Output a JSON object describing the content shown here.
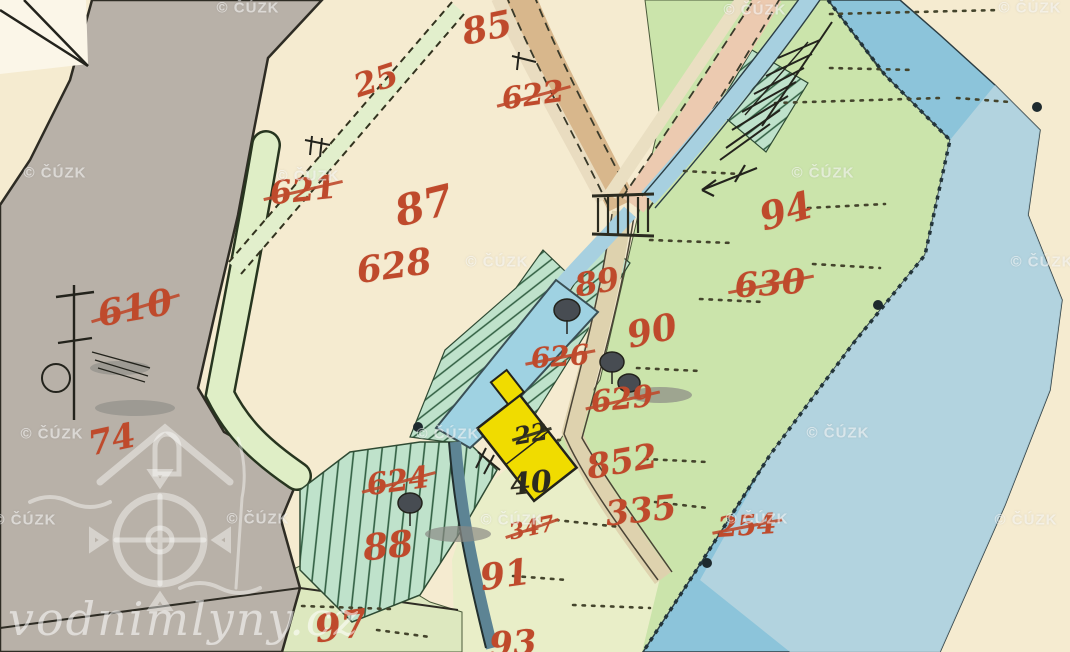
{
  "map": {
    "title": "historical cadastral map scan",
    "palette": {
      "paper": "#f5ebd0",
      "meadow_green": "#cbe4ab",
      "hatch_green": "#bfe2cb",
      "pale_green": "#e9eec8",
      "water_blue": "#8cc4da",
      "pond_blue": "#9fd2e2",
      "road_tan": "#d8b78c",
      "road_pink": "#eccab0",
      "gray_area": "#b8b1a8",
      "building_yellow": "#f0dc00",
      "red_ink": "#bf4a2c",
      "black_ink": "#2b2b20"
    }
  },
  "watermark": {
    "text": "© ČÚZK",
    "positions": [
      [
        248,
        8
      ],
      [
        755,
        10
      ],
      [
        1030,
        8
      ],
      [
        55,
        173
      ],
      [
        308,
        176
      ],
      [
        823,
        173
      ],
      [
        497,
        262
      ],
      [
        1042,
        262
      ],
      [
        52,
        434
      ],
      [
        448,
        434
      ],
      [
        838,
        433
      ],
      [
        25,
        520
      ],
      [
        258,
        519
      ],
      [
        512,
        520
      ],
      [
        757,
        519
      ],
      [
        1026,
        520
      ]
    ]
  },
  "logo_watermark": {
    "text": "vodnimlyny.cz"
  },
  "labels": [
    {
      "text": "85",
      "x": 487,
      "y": 28,
      "rot": -12,
      "size": 36,
      "color": "red",
      "crossed": false
    },
    {
      "text": "622",
      "x": 533,
      "y": 96,
      "rot": -8,
      "size": 30,
      "color": "red",
      "crossed": true
    },
    {
      "text": "25",
      "x": 376,
      "y": 80,
      "rot": -18,
      "size": 32,
      "color": "red",
      "crossed": false
    },
    {
      "text": "621",
      "x": 303,
      "y": 190,
      "rot": -6,
      "size": 32,
      "color": "red",
      "crossed": true
    },
    {
      "text": "87",
      "x": 424,
      "y": 206,
      "rot": -14,
      "size": 42,
      "color": "red",
      "crossed": false
    },
    {
      "text": "628",
      "x": 394,
      "y": 266,
      "rot": -8,
      "size": 36,
      "color": "red",
      "crossed": false
    },
    {
      "text": "610",
      "x": 135,
      "y": 308,
      "rot": -10,
      "size": 36,
      "color": "red",
      "crossed": true
    },
    {
      "text": "74",
      "x": 112,
      "y": 440,
      "rot": -12,
      "size": 34,
      "color": "red",
      "crossed": false
    },
    {
      "text": "94",
      "x": 786,
      "y": 211,
      "rot": -16,
      "size": 38,
      "color": "red",
      "crossed": false
    },
    {
      "text": "630",
      "x": 770,
      "y": 284,
      "rot": -4,
      "size": 34,
      "color": "red",
      "crossed": true
    },
    {
      "text": "89",
      "x": 597,
      "y": 282,
      "rot": -10,
      "size": 32,
      "color": "red",
      "crossed": false
    },
    {
      "text": "626",
      "x": 560,
      "y": 357,
      "rot": -4,
      "size": 28,
      "color": "red",
      "crossed": true
    },
    {
      "text": "90",
      "x": 652,
      "y": 331,
      "rot": -12,
      "size": 36,
      "color": "red",
      "crossed": false
    },
    {
      "text": "629",
      "x": 622,
      "y": 400,
      "rot": -6,
      "size": 30,
      "color": "red",
      "crossed": true
    },
    {
      "text": "852",
      "x": 622,
      "y": 462,
      "rot": -10,
      "size": 34,
      "color": "red",
      "crossed": false
    },
    {
      "text": "335",
      "x": 641,
      "y": 511,
      "rot": -6,
      "size": 34,
      "color": "red",
      "crossed": false
    },
    {
      "text": "254",
      "x": 747,
      "y": 526,
      "rot": -4,
      "size": 28,
      "color": "red",
      "crossed": true
    },
    {
      "text": "624",
      "x": 398,
      "y": 482,
      "rot": -8,
      "size": 30,
      "color": "red",
      "crossed": true
    },
    {
      "text": "88",
      "x": 388,
      "y": 546,
      "rot": -6,
      "size": 36,
      "color": "red",
      "crossed": false
    },
    {
      "text": "347",
      "x": 532,
      "y": 528,
      "rot": -12,
      "size": 22,
      "color": "red",
      "crossed": true
    },
    {
      "text": "91",
      "x": 505,
      "y": 575,
      "rot": -8,
      "size": 36,
      "color": "red",
      "crossed": false
    },
    {
      "text": "97",
      "x": 341,
      "y": 626,
      "rot": -8,
      "size": 38,
      "color": "red",
      "crossed": false
    },
    {
      "text": "93",
      "x": 513,
      "y": 644,
      "rot": -4,
      "size": 34,
      "color": "red",
      "crossed": false
    },
    {
      "text": "22",
      "x": 531,
      "y": 434,
      "rot": -10,
      "size": 24,
      "color": "black",
      "crossed": true
    },
    {
      "text": "40",
      "x": 531,
      "y": 484,
      "rot": -6,
      "size": 30,
      "color": "black",
      "crossed": false
    }
  ]
}
